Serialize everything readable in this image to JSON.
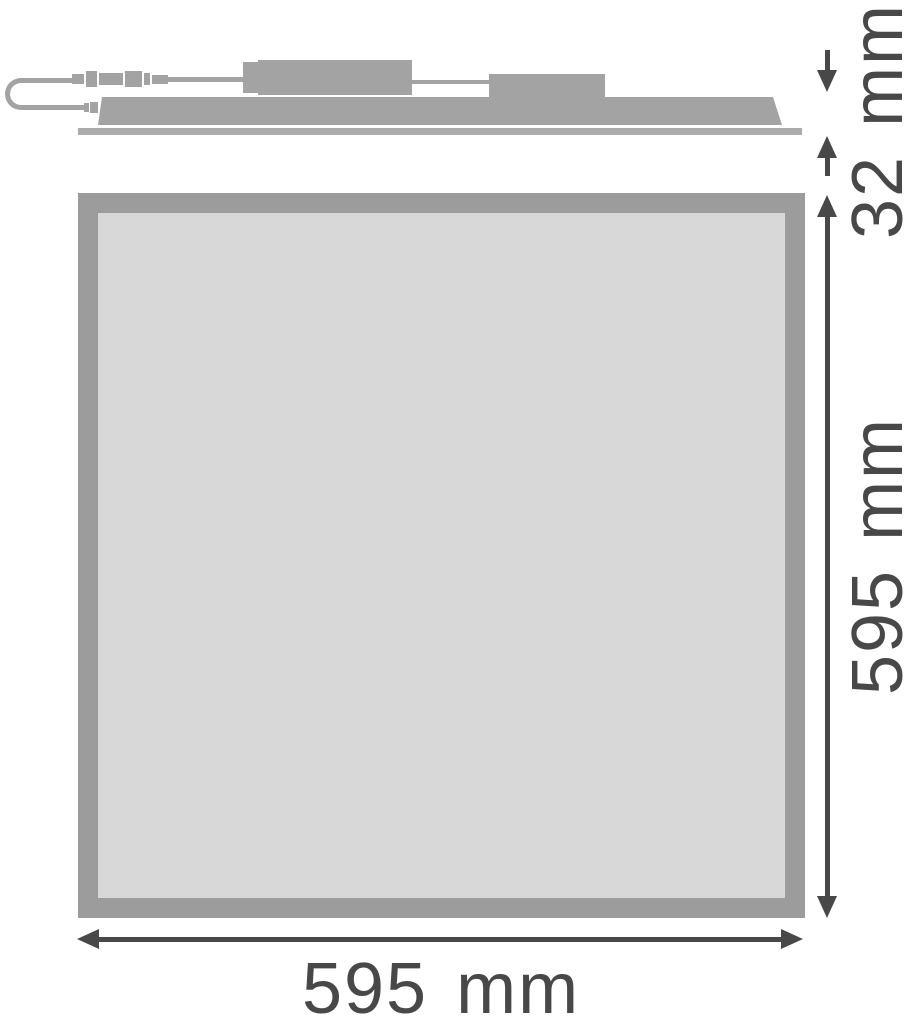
{
  "labels": {
    "profile_height": "32 mm",
    "panel_height": "595 mm",
    "panel_width": "595 mm"
  },
  "colors": {
    "part_gray": "#a3a3a3",
    "base_gray": "#acacac",
    "frame_gray": "#9c9c9c",
    "panel_fill": "#d8d8d8",
    "dimension": "#484848",
    "background": "#ffffff"
  }
}
